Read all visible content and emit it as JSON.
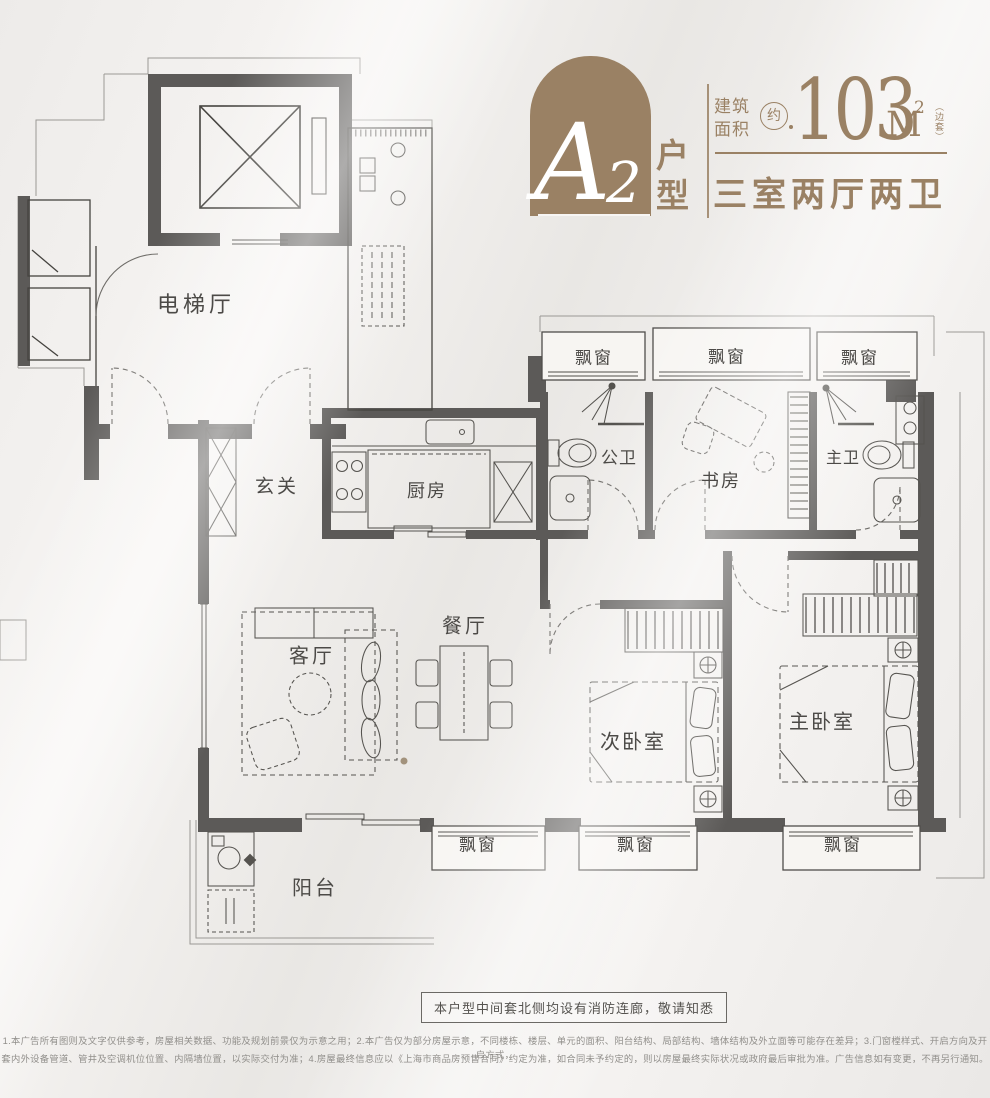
{
  "colors": {
    "accent": "#9a8164",
    "wall": "#5c5a58",
    "line": "#45433f",
    "paper": "#efedeb"
  },
  "header": {
    "unit_letter": "A",
    "unit_digit": "2",
    "unit_type_vertical": "户型",
    "area_label": "建筑面积",
    "approx_badge": "约",
    "area_value": "103",
    "area_unit": "M",
    "area_exponent": "2",
    "area_bracket_note": "（边套）",
    "layout_summary": "三室两厅两卫"
  },
  "plan": {
    "rooms": [
      {
        "id": "elevator-hall",
        "label": "电梯厅"
      },
      {
        "id": "foyer",
        "label": "玄关"
      },
      {
        "id": "kitchen",
        "label": "厨房"
      },
      {
        "id": "public-bath",
        "label": "公卫"
      },
      {
        "id": "study",
        "label": "书房"
      },
      {
        "id": "master-bath",
        "label": "主卫"
      },
      {
        "id": "living-room",
        "label": "客厅"
      },
      {
        "id": "dining-room",
        "label": "餐厅"
      },
      {
        "id": "second-bedroom",
        "label": "次卧室"
      },
      {
        "id": "master-bedroom",
        "label": "主卧室"
      },
      {
        "id": "balcony",
        "label": "阳台"
      }
    ],
    "bay_windows": [
      {
        "label": "飘窗"
      },
      {
        "label": "飘窗"
      },
      {
        "label": "飘窗"
      },
      {
        "label": "飘窗"
      },
      {
        "label": "飘窗"
      },
      {
        "label": "飘窗"
      }
    ]
  },
  "notice": {
    "text": "本户型中间套北侧均设有消防连廊，敬请知悉"
  },
  "disclaimer": {
    "line1": "1.本广告所有图则及文字仅供参考，房屋相关数据、功能及规划前景仅为示意之用；2.本广告仅为部分房屋示意，不同楼栋、楼层、单元的面积、阳台结构、局部结构、墙体结构及外立面等可能存在差异；3.门窗樘样式、开启方向及开启方式，",
    "line2": "套内外设备管道、管井及空调机位位置、内隔墙位置，以实际交付为准；4.房屋最终信息应以《上海市商品房预售合同》约定为准，如合同未予约定的，则以房屋最终实际状况或政府最后审批为准。广告信息如有变更，不再另行通知。"
  }
}
